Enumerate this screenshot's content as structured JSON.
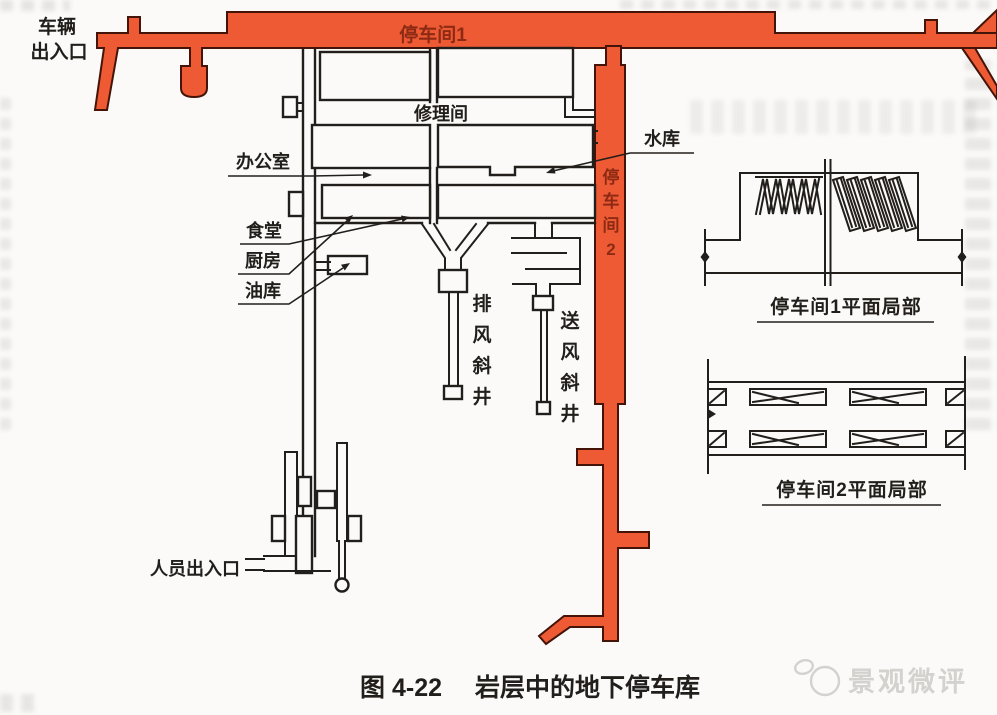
{
  "colors": {
    "corridor_fill": "#ee5a33",
    "corridor_stroke": "#431407",
    "corridor_label": "#8d2a14",
    "line": "#221e1b",
    "paper": "#fbfaf8",
    "watermark": "#d4d2cf"
  },
  "plan_labels": {
    "vehicle_entrance_line1": "车辆",
    "vehicle_entrance_line2": "出入口",
    "parking_room_1": "停车间1",
    "repair_room": "修理间",
    "office": "办公室",
    "reservoir": "水库",
    "canteen": "食堂",
    "kitchen": "厨房",
    "oil_depot": "油库",
    "personnel_entrance": "人员出入口",
    "parking_room_2_vertical": [
      "停",
      "车",
      "间",
      "2"
    ],
    "exhaust_shaft_vertical": [
      "排",
      "风",
      "斜",
      "井"
    ],
    "supply_shaft_vertical": [
      "送",
      "风",
      "斜",
      "井"
    ]
  },
  "detail_views": {
    "detail1_caption": "停车间1平面局部",
    "detail2_caption": "停车间2平面局部"
  },
  "figure_caption": {
    "number": "图 4-22",
    "title": "岩层中的地下停车库"
  },
  "watermark": {
    "text": "景观微评"
  }
}
